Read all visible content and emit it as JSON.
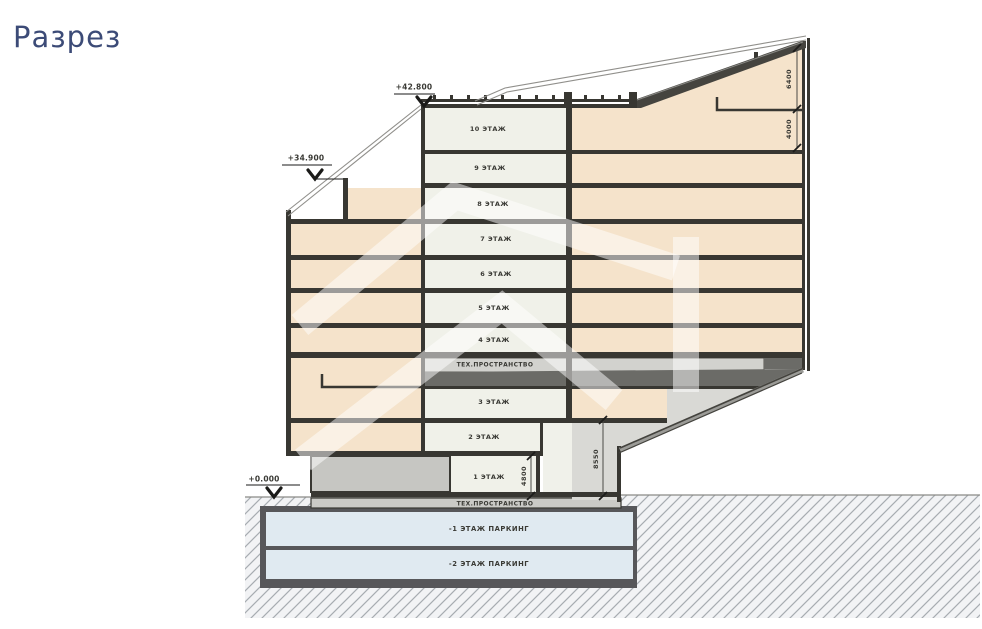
{
  "title": "Разрез",
  "elevations": [
    {
      "label": "+42.800"
    },
    {
      "label": "+34.900"
    },
    {
      "label": "+0.000"
    }
  ],
  "floors": [
    {
      "label": "10 ЭТАЖ"
    },
    {
      "label": "9 ЭТАЖ"
    },
    {
      "label": "8 ЭТАЖ"
    },
    {
      "label": "7 ЭТАЖ"
    },
    {
      "label": "6 ЭТАЖ"
    },
    {
      "label": "5 ЭТАЖ"
    },
    {
      "label": "4 ЭТАЖ"
    },
    {
      "label": "ТЕХ.ПРОСТРАНСТВО"
    },
    {
      "label": "3 ЭТАЖ"
    },
    {
      "label": "2 ЭТАЖ"
    },
    {
      "label": "1 ЭТАЖ"
    },
    {
      "label": "ТЕХ.ПРОСТРАНСТВО"
    },
    {
      "label": "-1 ЭТАЖ ПАРКИНГ"
    },
    {
      "label": "-2 ЭТАЖ ПАРКИНГ"
    }
  ],
  "dimensions": [
    {
      "label": "6400"
    },
    {
      "label": "4000"
    },
    {
      "label": "8550"
    },
    {
      "label": "4800"
    }
  ],
  "colors": {
    "title_accent": "#3c4b77",
    "room_cream": "#f0f1e9",
    "room_peach": "#f5e3cb",
    "parking_blue": "#e0eaf1",
    "structure_dark": "#383732",
    "tech_light": "#d2d2ce",
    "tech_dark": "#6b6b67"
  }
}
